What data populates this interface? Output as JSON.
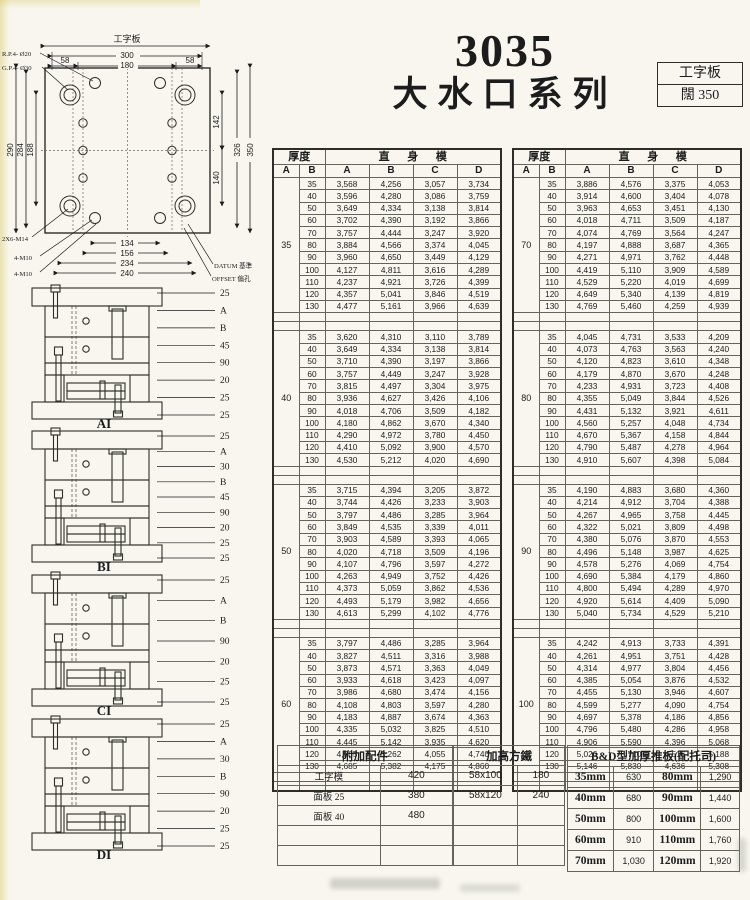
{
  "colors": {
    "paper": "#f8f6ef",
    "ink": "#1c1c1c",
    "line": "#66635b"
  },
  "header": {
    "model": "3035",
    "series": "大水口系列",
    "spec_box": {
      "row1": "工字板",
      "row2": "闊 350"
    }
  },
  "top_drawing": {
    "title": "工字板",
    "width_dims": [
      "300",
      "180",
      "58",
      "58"
    ],
    "left_dims": [
      "290",
      "284",
      "188"
    ],
    "right_dims": [
      "142",
      "140",
      "326",
      "350"
    ],
    "bottom_dims": [
      "134",
      "156",
      "234",
      "240"
    ],
    "notes": [
      "R.P.4- Ø20",
      "G.P.4- Ø30",
      "2X6-M14",
      "4-M10",
      "4-M10",
      "DATUM 基準",
      "OFFSET 偏孔"
    ]
  },
  "side_views": [
    {
      "label": "AI",
      "callouts": [
        "25",
        "A",
        "B",
        "45",
        "90",
        "20",
        "25",
        "25"
      ]
    },
    {
      "label": "BI",
      "callouts": [
        "25",
        "A",
        "30",
        "B",
        "45",
        "90",
        "20",
        "25",
        "25"
      ]
    },
    {
      "label": "CI",
      "callouts": [
        "25",
        "A",
        "B",
        "90",
        "20",
        "25",
        "25"
      ]
    },
    {
      "label": "DI",
      "callouts": [
        "25",
        "A",
        "30",
        "B",
        "90",
        "20",
        "25",
        "25"
      ]
    }
  ],
  "main_table": {
    "header": {
      "thickness": "厚度",
      "straight_mold": "直身模",
      "sub": [
        "A",
        "B",
        "A",
        "B",
        "C",
        "D"
      ]
    },
    "b_values": [
      "35",
      "40",
      "50",
      "60",
      "70",
      "80",
      "90",
      "100",
      "110",
      "120",
      "130"
    ],
    "left_groups": [
      {
        "thickness": "35",
        "rows": [
          [
            "3,568",
            "4,256",
            "3,057",
            "3,734"
          ],
          [
            "3,596",
            "4,280",
            "3,086",
            "3,759"
          ],
          [
            "3,649",
            "4,334",
            "3,138",
            "3,814"
          ],
          [
            "3,702",
            "4,390",
            "3,192",
            "3,866"
          ],
          [
            "3,757",
            "4,444",
            "3,247",
            "3,920"
          ],
          [
            "3,884",
            "4,566",
            "3,374",
            "4,045"
          ],
          [
            "3,960",
            "4,650",
            "3,449",
            "4,129"
          ],
          [
            "4,127",
            "4,811",
            "3,616",
            "4,289"
          ],
          [
            "4,237",
            "4,921",
            "3,726",
            "4,399"
          ],
          [
            "4,357",
            "5,041",
            "3,846",
            "4,519"
          ],
          [
            "4,477",
            "5,161",
            "3,966",
            "4,639"
          ]
        ]
      },
      {
        "thickness": "40",
        "rows": [
          [
            "3,620",
            "4,310",
            "3,110",
            "3,789"
          ],
          [
            "3,649",
            "4,334",
            "3,138",
            "3,814"
          ],
          [
            "3,710",
            "4,390",
            "3,197",
            "3,866"
          ],
          [
            "3,757",
            "4,449",
            "3,247",
            "3,928"
          ],
          [
            "3,815",
            "4,497",
            "3,304",
            "3,975"
          ],
          [
            "3,936",
            "4,627",
            "3,426",
            "4,106"
          ],
          [
            "4,018",
            "4,706",
            "3,509",
            "4,182"
          ],
          [
            "4,180",
            "4,862",
            "3,670",
            "4,340"
          ],
          [
            "4,290",
            "4,972",
            "3,780",
            "4,450"
          ],
          [
            "4,410",
            "5,092",
            "3,900",
            "4,570"
          ],
          [
            "4,530",
            "5,212",
            "4,020",
            "4,690"
          ]
        ]
      },
      {
        "thickness": "50",
        "rows": [
          [
            "3,715",
            "4,394",
            "3,205",
            "3,872"
          ],
          [
            "3,744",
            "4,426",
            "3,233",
            "3,903"
          ],
          [
            "3,797",
            "4,486",
            "3,285",
            "3,964"
          ],
          [
            "3,849",
            "4,535",
            "3,339",
            "4,011"
          ],
          [
            "3,903",
            "4,589",
            "3,393",
            "4,065"
          ],
          [
            "4,020",
            "4,718",
            "3,509",
            "4,196"
          ],
          [
            "4,107",
            "4,796",
            "3,597",
            "4,272"
          ],
          [
            "4,263",
            "4,949",
            "3,752",
            "4,426"
          ],
          [
            "4,373",
            "5,059",
            "3,862",
            "4,536"
          ],
          [
            "4,493",
            "5,179",
            "3,982",
            "4,656"
          ],
          [
            "4,613",
            "5,299",
            "4,102",
            "4,776"
          ]
        ]
      },
      {
        "thickness": "60",
        "rows": [
          [
            "3,797",
            "4,486",
            "3,285",
            "3,964"
          ],
          [
            "3,827",
            "4,511",
            "3,316",
            "3,988"
          ],
          [
            "3,873",
            "4,571",
            "3,363",
            "4,049"
          ],
          [
            "3,933",
            "4,618",
            "3,423",
            "4,097"
          ],
          [
            "3,986",
            "4,680",
            "3,474",
            "4,156"
          ],
          [
            "4,108",
            "4,803",
            "3,597",
            "4,280"
          ],
          [
            "4,183",
            "4,887",
            "3,674",
            "4,363"
          ],
          [
            "4,335",
            "5,032",
            "3,825",
            "4,510"
          ],
          [
            "4,445",
            "5,142",
            "3,935",
            "4,620"
          ],
          [
            "4,565",
            "5,262",
            "4,055",
            "4,740"
          ],
          [
            "4,685",
            "5,382",
            "4,175",
            "4,860"
          ]
        ]
      }
    ],
    "right_groups": [
      {
        "thickness": "70",
        "rows": [
          [
            "3,886",
            "4,576",
            "3,375",
            "4,053"
          ],
          [
            "3,914",
            "4,600",
            "3,404",
            "4,078"
          ],
          [
            "3,963",
            "4,653",
            "3,451",
            "4,130"
          ],
          [
            "4,018",
            "4,711",
            "3,509",
            "4,187"
          ],
          [
            "4,074",
            "4,769",
            "3,564",
            "4,247"
          ],
          [
            "4,197",
            "4,888",
            "3,687",
            "4,365"
          ],
          [
            "4,271",
            "4,971",
            "3,762",
            "4,448"
          ],
          [
            "4,419",
            "5,110",
            "3,909",
            "4,589"
          ],
          [
            "4,529",
            "5,220",
            "4,019",
            "4,699"
          ],
          [
            "4,649",
            "5,340",
            "4,139",
            "4,819"
          ],
          [
            "4,769",
            "5,460",
            "4,259",
            "4,939"
          ]
        ]
      },
      {
        "thickness": "80",
        "rows": [
          [
            "4,045",
            "4,731",
            "3,533",
            "4,209"
          ],
          [
            "4,073",
            "4,763",
            "3,563",
            "4,240"
          ],
          [
            "4,120",
            "4,823",
            "3,610",
            "4,348"
          ],
          [
            "4,179",
            "4,870",
            "3,670",
            "4,248"
          ],
          [
            "4,233",
            "4,931",
            "3,723",
            "4,408"
          ],
          [
            "4,355",
            "5,049",
            "3,844",
            "4,526"
          ],
          [
            "4,431",
            "5,132",
            "3,921",
            "4,611"
          ],
          [
            "4,560",
            "5,257",
            "4,048",
            "4,734"
          ],
          [
            "4,670",
            "5,367",
            "4,158",
            "4,844"
          ],
          [
            "4,790",
            "5,487",
            "4,278",
            "4,964"
          ],
          [
            "4,910",
            "5,607",
            "4,398",
            "5,084"
          ]
        ]
      },
      {
        "thickness": "90",
        "rows": [
          [
            "4,190",
            "4,883",
            "3,680",
            "4,360"
          ],
          [
            "4,214",
            "4,912",
            "3,704",
            "4,388"
          ],
          [
            "4,267",
            "4,965",
            "3,758",
            "4,445"
          ],
          [
            "4,322",
            "5,021",
            "3,809",
            "4,498"
          ],
          [
            "4,380",
            "5,076",
            "3,870",
            "4,553"
          ],
          [
            "4,496",
            "5,148",
            "3,987",
            "4,625"
          ],
          [
            "4,578",
            "5,276",
            "4,069",
            "4,754"
          ],
          [
            "4,690",
            "5,384",
            "4,179",
            "4,860"
          ],
          [
            "4,800",
            "5,494",
            "4,289",
            "4,970"
          ],
          [
            "4,920",
            "5,614",
            "4,409",
            "5,090"
          ],
          [
            "5,040",
            "5,734",
            "4,529",
            "5,210"
          ]
        ]
      },
      {
        "thickness": "100",
        "rows": [
          [
            "4,242",
            "4,913",
            "3,733",
            "4,391"
          ],
          [
            "4,261",
            "4,951",
            "3,751",
            "4,428"
          ],
          [
            "4,314",
            "4,977",
            "3,804",
            "4,456"
          ],
          [
            "4,385",
            "5,054",
            "3,876",
            "4,532"
          ],
          [
            "4,455",
            "5,130",
            "3,946",
            "4,607"
          ],
          [
            "4,599",
            "5,277",
            "4,090",
            "4,754"
          ],
          [
            "4,697",
            "5,378",
            "4,186",
            "4,856"
          ],
          [
            "4,796",
            "5,480",
            "4,286",
            "4,958"
          ],
          [
            "4,906",
            "5,590",
            "4,396",
            "5,068"
          ],
          [
            "5,026",
            "5,710",
            "4,516",
            "5,188"
          ],
          [
            "5,146",
            "5,830",
            "4,636",
            "5,308"
          ]
        ]
      }
    ]
  },
  "bottom_tables": {
    "accessories": {
      "title": "附加配件",
      "rows": [
        [
          "工字模",
          "420"
        ],
        [
          "面板 25",
          "380"
        ],
        [
          "面板 40",
          "480"
        ],
        [
          "",
          ""
        ],
        [
          "",
          ""
        ]
      ]
    },
    "riser": {
      "title": "加高方鐵",
      "rows": [
        [
          "58x100",
          "180"
        ],
        [
          "58x120",
          "240"
        ],
        [
          "",
          ""
        ],
        [
          "",
          ""
        ],
        [
          "",
          ""
        ]
      ]
    },
    "bd": {
      "title": "B&D型加厚推板(配托司)",
      "rows": [
        [
          "35mm",
          "630",
          "80mm",
          "1,290"
        ],
        [
          "40mm",
          "680",
          "90mm",
          "1,440"
        ],
        [
          "50mm",
          "800",
          "100mm",
          "1,600"
        ],
        [
          "60mm",
          "910",
          "110mm",
          "1,760"
        ],
        [
          "70mm",
          "1,030",
          "120mm",
          "1,920"
        ]
      ]
    }
  }
}
